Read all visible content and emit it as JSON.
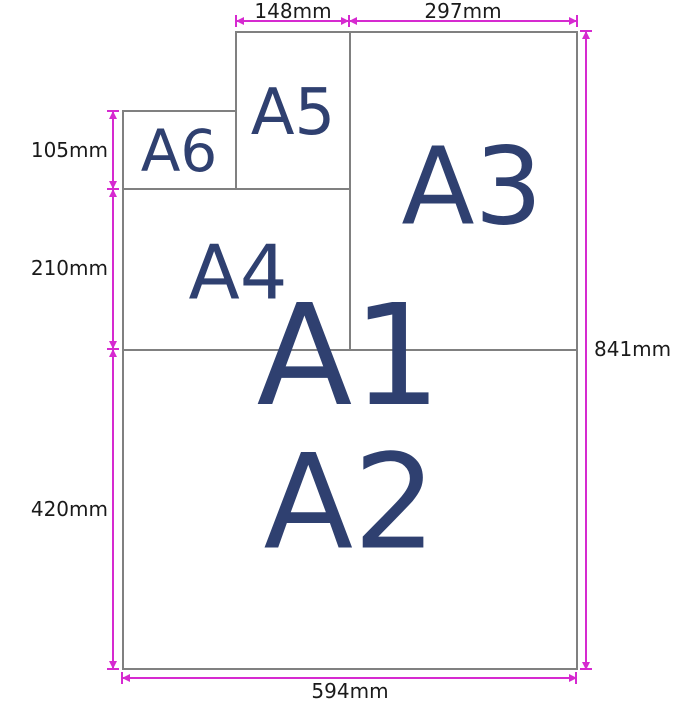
{
  "diagram": {
    "description": "Nested ISO A-series paper size comparison diagram"
  },
  "sheets": [
    {
      "label": "A1"
    },
    {
      "label": "A2"
    },
    {
      "label": "A3"
    },
    {
      "label": "A4"
    },
    {
      "label": "A5"
    },
    {
      "label": "A6"
    }
  ],
  "measurements": [
    {
      "value": "148mm",
      "side": "top",
      "spans": "A5 width"
    },
    {
      "value": "297mm",
      "side": "top",
      "spans": "A3 width"
    },
    {
      "value": "105mm",
      "side": "left",
      "spans": "A6 height"
    },
    {
      "value": "210mm",
      "side": "left",
      "spans": "A4 height"
    },
    {
      "value": "420mm",
      "side": "left",
      "spans": "A2 height"
    },
    {
      "value": "841mm",
      "side": "right",
      "spans": "A1 height"
    },
    {
      "value": "594mm",
      "side": "bottom",
      "spans": "A1 width"
    }
  ],
  "colors": {
    "dimension_line": "#d62ad0",
    "sheet_border": "#808080",
    "paper_label": "#2f4070",
    "dimension_text": "#1a1a1a",
    "background": "#ffffff"
  }
}
